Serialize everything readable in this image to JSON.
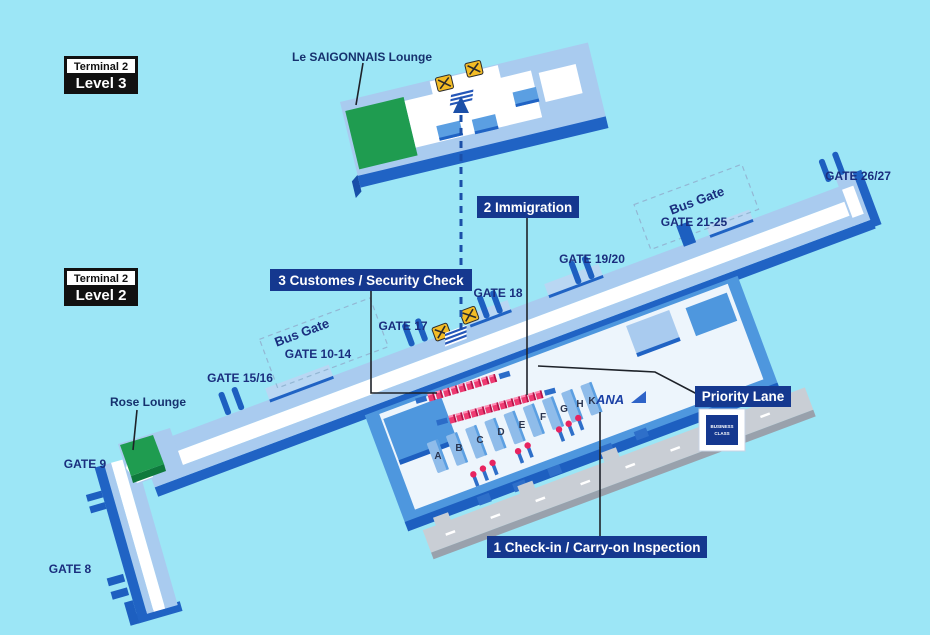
{
  "level_badges": {
    "level3": {
      "terminal": "Terminal 2",
      "level": "Level 3"
    },
    "level2": {
      "terminal": "Terminal 2",
      "level": "Level 2"
    }
  },
  "lounges": {
    "saigonnais": "Le SAIGONNAIS Lounge",
    "rose": "Rose Lounge"
  },
  "flow_callouts": {
    "checkin": "1 Check-in / Carry-on Inspection",
    "immigration": "2 Immigration",
    "customs_security": "3 Customes / Security Check",
    "priority_lane": "Priority Lane"
  },
  "priority_badge": {
    "line1": "BUSINESS",
    "line2": "CLASS"
  },
  "gates": {
    "gate8": "GATE 8",
    "gate9": "GATE 9",
    "gate10_14": "GATE 10-14",
    "gate15_16": "GATE 15/16",
    "gate17": "GATE 17",
    "gate18": "GATE 18",
    "gate19_20": "GATE 19/20",
    "gate21_25": "GATE 21-25",
    "gate26_27": "GATE 26/27"
  },
  "bus_gates": {
    "left": "Bus Gate",
    "right": "Bus Gate"
  },
  "checkin_counters": [
    "A",
    "B",
    "C",
    "D",
    "E",
    "F",
    "G",
    "H",
    "K"
  ],
  "airline": {
    "name": "ANA"
  },
  "colors": {
    "background": "#9CE6F6",
    "terminal_fill": "#A9CBEF",
    "terminal_edge": "#2063C4",
    "bridge_blue": "#1D5FC0",
    "walkway_white": "#FFFFFF",
    "hall_blue": "#4E97DE",
    "counter_blue": "#8FBCEA",
    "lounge_green": "#1F9C50",
    "escalator_yellow": "#F3BC25",
    "booth_red": "#EE3A71",
    "curb_gray": "#C9CED5",
    "label_navy": "#15388F",
    "text_navy": "#1A2E7E"
  }
}
